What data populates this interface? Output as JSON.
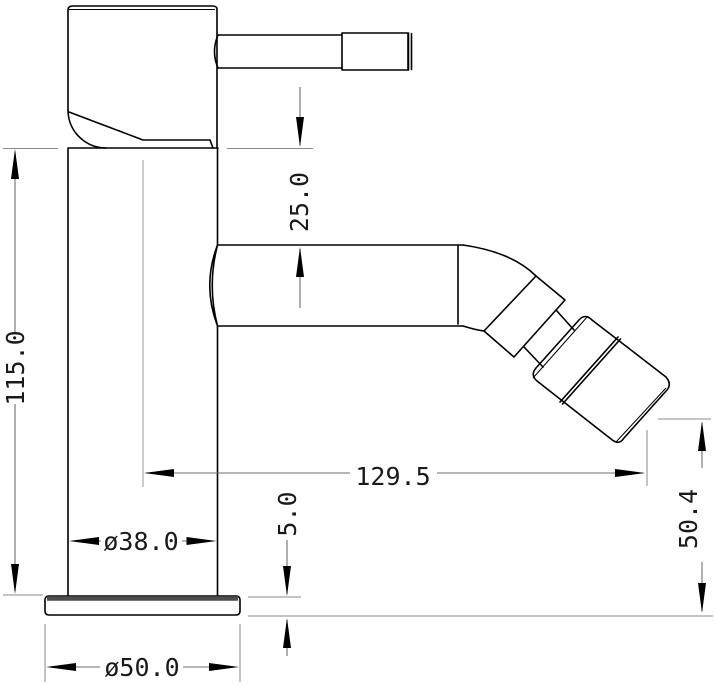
{
  "drawing": {
    "kind": "technical-drawing",
    "subject": "single-lever bidet mixer tap - side elevation",
    "units": "mm",
    "colors": {
      "object_line": "#000000",
      "dimension_line": "#6e6e6e",
      "extension_line": "#8a8a8a",
      "label_text": "#1a1a1a",
      "background": "#ffffff"
    },
    "dimensions": {
      "overall_height": {
        "label": "115.0",
        "orientation": "vertical"
      },
      "spout_offset": {
        "label": "25.0",
        "orientation": "vertical"
      },
      "spout_reach": {
        "label": "129.5",
        "orientation": "horizontal"
      },
      "body_diameter": {
        "label": "ø38.0",
        "orientation": "horizontal"
      },
      "base_diameter": {
        "label": "ø50.0",
        "orientation": "horizontal"
      },
      "base_thickness": {
        "label": "5.0",
        "orientation": "vertical"
      },
      "outlet_height": {
        "label": "50.4",
        "orientation": "vertical"
      }
    }
  }
}
